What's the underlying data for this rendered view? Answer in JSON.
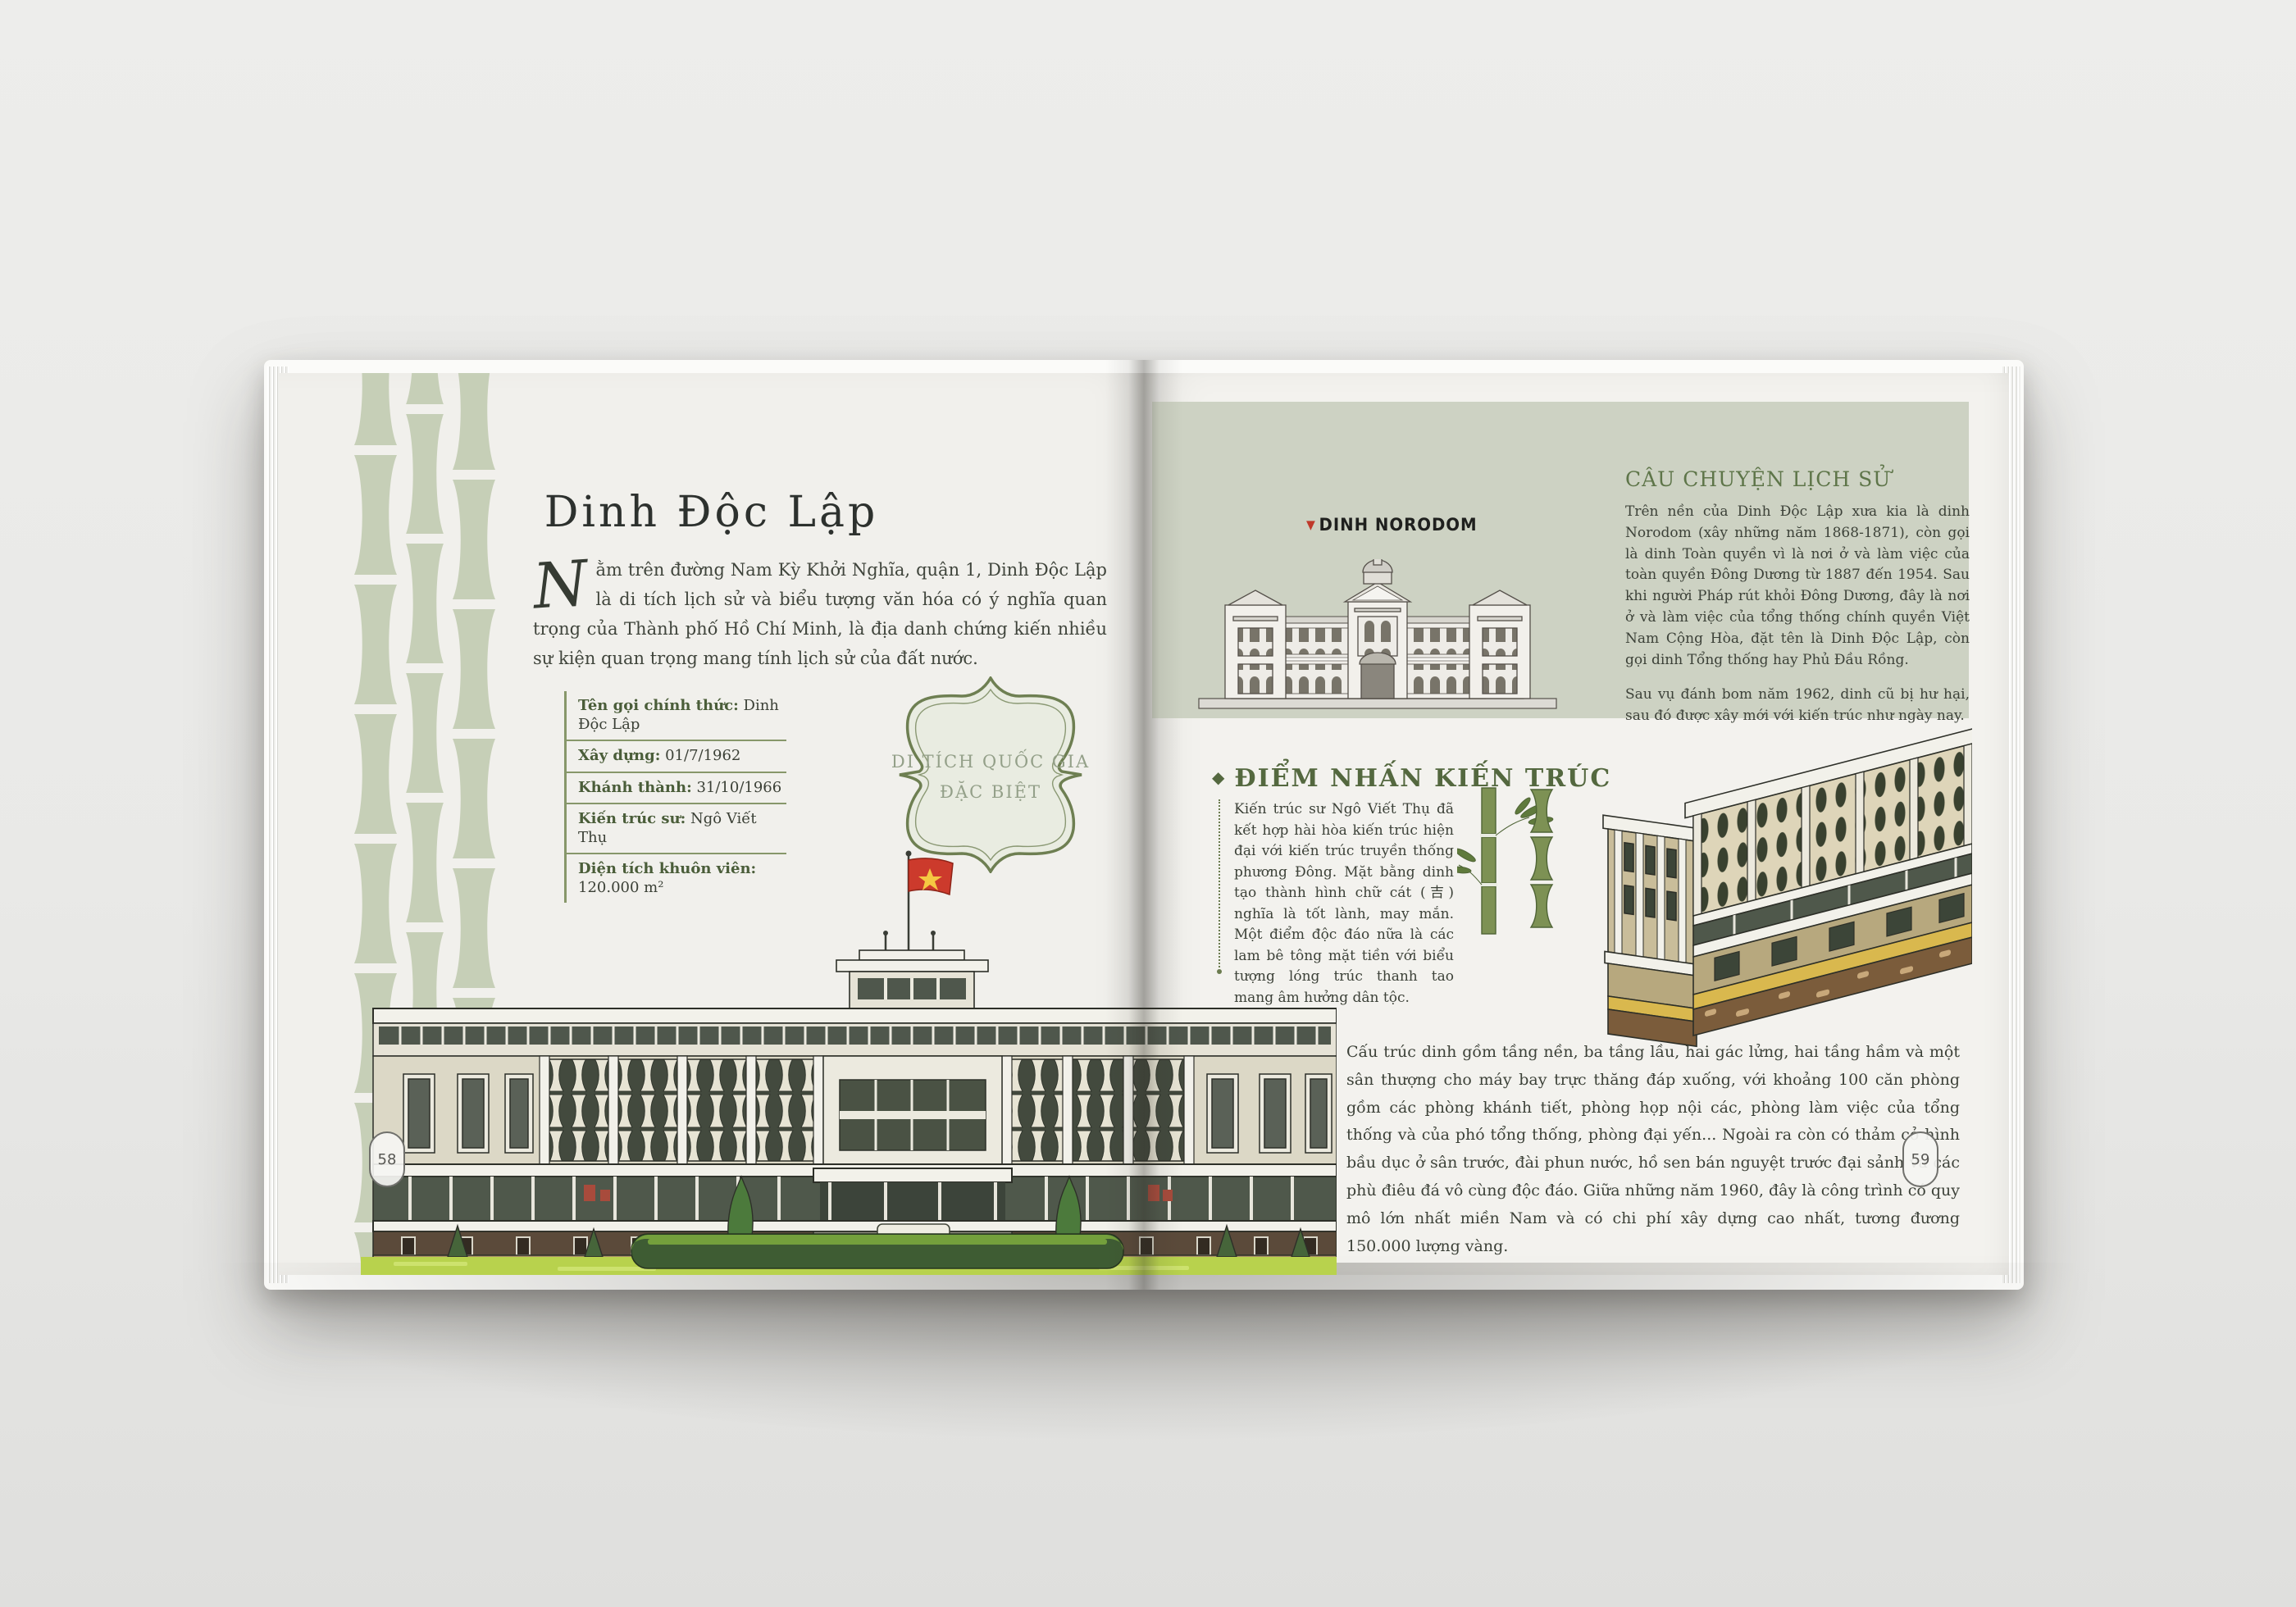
{
  "book": {
    "left_page": {
      "page_number": "58",
      "title": "Dinh Độc Lập",
      "intro_drop_cap": "N",
      "intro_rest": "ằm trên đường Nam Kỳ Khởi Nghĩa, quận 1, Dinh Độc Lập là di tích lịch sử và biểu tượng văn hóa có ý nghĩa quan trọng của Thành phố Hồ Chí Minh, là địa danh chứng kiến nhiều sự kiện quan trọng mang tính lịch sử của đất nước.",
      "facts": [
        {
          "label": "Tên gọi chính thức:",
          "value": "Dinh Độc Lập"
        },
        {
          "label": "Xây dựng:",
          "value": "01/7/1962"
        },
        {
          "label": "Khánh thành:",
          "value": "31/10/1966"
        },
        {
          "label": "Kiến trúc sư:",
          "value": "Ngô Viết Thụ"
        },
        {
          "label": "Diện tích khuôn viên:",
          "value": "120.000 m²"
        }
      ],
      "badge_line1": "DI TÍCH QUỐC GIA",
      "badge_line2": "ĐẶC BIỆT"
    },
    "right_page": {
      "page_number": "59",
      "norodom_label": "DINH NORODOM",
      "history": {
        "heading": "CÂU CHUYỆN LỊCH SỬ",
        "para1": "Trên nền của Dinh Độc Lập xưa kia là dinh Norodom (xây những năm 1868-1871), còn gọi là dinh Toàn quyền vì là nơi ở và làm việc của toàn quyền Đông Dương từ 1887 đến 1954. Sau khi người Pháp rút khỏi Đông Dương, đây là nơi ở và làm việc của tổng thống chính quyền Việt Nam Cộng Hòa, đặt tên là Dinh Độc Lập, còn gọi dinh Tổng thống hay Phủ Đầu Rồng.",
        "para2": "Sau vụ đánh bom năm 1962, dinh cũ bị hư hại, sau đó được xây mới với kiến trúc như ngày nay."
      },
      "architecture": {
        "heading": "ĐIỂM NHẤN KIẾN TRÚC",
        "para": "Kiến trúc sư Ngô Viết Thụ đã kết hợp hài hòa kiến trúc hiện đại với kiến trúc truyền thống phương Đông. Mặt bằng dinh tạo thành hình chữ cát (吉) nghĩa là tốt lành, may mắn. Một điểm độc đáo nữa là các lam bê tông mặt tiền với biểu tượng lóng trúc thanh tao mang âm hưởng dân tộc."
      },
      "structure_para": "Cấu trúc dinh gồm tầng nền, ba tầng lầu, hai gác lửng, hai tầng hầm và một sân thượng cho máy bay trực thăng đáp xuống, với khoảng 100 căn phòng gồm các phòng khánh tiết, phòng họp nội các, phòng làm việc của tổng thống và của phó tổng thống, phòng đại yến... Ngoài ra còn có thảm cỏ hình bầu dục ở sân trước, đài phun nước, hồ sen bán nguyệt trước đại sảnh và các phù điêu đá vô cùng độc đáo. Giữa những năm 1960, đây là công trình có quy mô lớn nhất miền Nam và có chi phí xây dựng cao nhất, tương đương 150.000 lượng vàng."
    },
    "colors": {
      "sage_panel": "#cdd2c3",
      "bamboo_pale": "#c6cfb7",
      "heading_olive": "#5e7549",
      "heading_dark_olive": "#54683f",
      "table_label_green": "#4a5d39",
      "rule_green": "#87976a",
      "flag_red": "#cc3a2c",
      "star_yellow": "#f5c842",
      "marker_red": "#bf3a2b",
      "bamboo_green": "#7d9154",
      "lawn_green": "#b8d24d",
      "hedge_green": "#3e5c33"
    }
  }
}
